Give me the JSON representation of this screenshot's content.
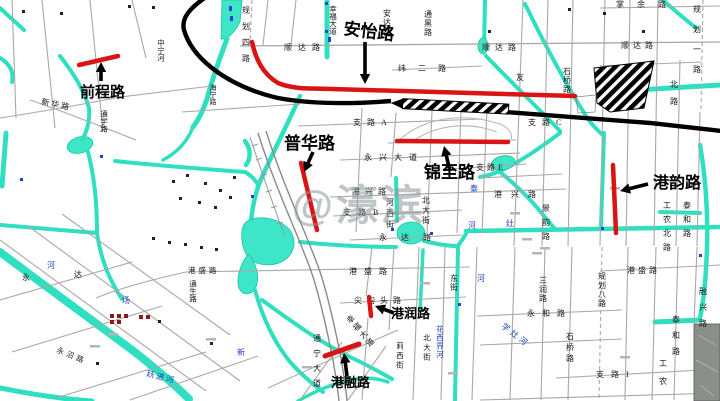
{
  "watermark": {
    "text": "@濠滨"
  },
  "colors": {
    "highlight": "#d81414",
    "river": "#2fdfbf",
    "pond": "#3ce6c6",
    "road_gray": "#a8a8a8",
    "black_road": "#000000",
    "blue_text": "#1d3fbb",
    "label_black": "#161616"
  },
  "highlighted_roads": [
    {
      "name": "前程路",
      "label": {
        "x": 80,
        "y": 97,
        "size": 15,
        "rot": 0
      },
      "path": "M79,65 L118,56",
      "width": 4.5,
      "arrow": {
        "x1": 101,
        "y1": 81,
        "x2": 101,
        "y2": 62
      }
    },
    {
      "name": "安怡路",
      "label": {
        "x": 343,
        "y": 34,
        "size": 17,
        "rot": 7
      },
      "path": "M252,42 C256,60 263,74 278,83 C295,90 312,88 332,89 L575,96",
      "width": 4.5,
      "arrow": {
        "x1": 365,
        "y1": 42,
        "x2": 365,
        "y2": 84
      }
    },
    {
      "name": "普华路",
      "label": {
        "x": 284,
        "y": 149,
        "size": 17,
        "rot": 0
      },
      "path": "M301,163 L317,230",
      "width": 4.5,
      "arrow": {
        "x1": 313,
        "y1": 152,
        "x2": 304,
        "y2": 172
      }
    },
    {
      "name": "锦至路",
      "label": {
        "x": 424,
        "y": 178,
        "size": 17,
        "rot": 0
      },
      "path": "M397,141 L508,142",
      "width": 4.5,
      "arrow": {
        "x1": 450,
        "y1": 171,
        "x2": 444,
        "y2": 146
      }
    },
    {
      "name": "港韵路",
      "label": {
        "x": 653,
        "y": 188,
        "size": 16,
        "rot": 0
      },
      "path": "M613,165 L616,233",
      "width": 4.5,
      "arrow": {
        "x1": 648,
        "y1": 184,
        "x2": 620,
        "y2": 191
      }
    },
    {
      "name": "港润路",
      "label": {
        "x": 391,
        "y": 318,
        "size": 13,
        "rot": 0
      },
      "path": "M369,297 L371,316",
      "width": 4.5,
      "arrow": {
        "x1": 394,
        "y1": 313,
        "x2": 375,
        "y2": 306
      }
    },
    {
      "name": "港融路",
      "label": {
        "x": 331,
        "y": 387,
        "size": 13,
        "rot": 0
      },
      "path": "M325,356 L359,344",
      "width": 5,
      "arrow": {
        "x1": 347,
        "y1": 376,
        "x2": 344,
        "y2": 353
      }
    }
  ],
  "street_labels": [
    {
      "t": "顺达路",
      "x": 284,
      "y": 50,
      "sp": 6
    },
    {
      "t": "规划四路",
      "x": 246,
      "y": 6,
      "o": "v",
      "sp": 8
    },
    {
      "t": "幸福大道",
      "x": 333,
      "y": 5,
      "o": "v",
      "s": 7.5
    },
    {
      "t": "安达路",
      "x": 387,
      "y": 9,
      "o": "v",
      "sp": 1
    },
    {
      "t": "通黑路",
      "x": 428,
      "y": 10,
      "o": "v",
      "sp": 1
    },
    {
      "t": "纬二路",
      "x": 398,
      "y": 71,
      "sp": 12
    },
    {
      "t": "支路A",
      "x": 353,
      "y": 125,
      "sp": 6
    },
    {
      "t": "掌余路",
      "x": 616,
      "y": 7,
      "sp": 13
    },
    {
      "t": "顺达路",
      "x": 482,
      "y": 50,
      "sp": 5
    },
    {
      "t": "顺达路",
      "x": 621,
      "y": 48,
      "sp": 4
    },
    {
      "t": "石桥路",
      "x": 567,
      "y": 67,
      "o": "v",
      "sp": 1
    },
    {
      "t": "友",
      "x": 516,
      "y": 80
    },
    {
      "t": "支路C",
      "x": 528,
      "y": 125,
      "sp": 6
    },
    {
      "t": "规划一路",
      "x": 697,
      "y": 5,
      "o": "v",
      "sp": 12
    },
    {
      "t": "北路",
      "x": 674,
      "y": 80,
      "o": "v",
      "sp": 9
    },
    {
      "t": "永兴大道",
      "x": 364,
      "y": 160,
      "sp": 7
    },
    {
      "t": "港兴路",
      "x": 352,
      "y": 194,
      "sp": 5
    },
    {
      "t": "支路B",
      "x": 343,
      "y": 215,
      "sp": 7
    },
    {
      "t": "支路E",
      "x": 476,
      "y": 170,
      "sp": 3
    },
    {
      "t": "港兴路",
      "x": 494,
      "y": 197,
      "sp": 9
    },
    {
      "t": "北大街",
      "x": 426,
      "y": 196,
      "o": "v",
      "sp": 2
    },
    {
      "t": "河西街",
      "x": 390,
      "y": 198,
      "o": "v",
      "sp": 3
    },
    {
      "t": "景韵路",
      "x": 546,
      "y": 204,
      "o": "v",
      "sp": 6
    },
    {
      "t": "永达路",
      "x": 379,
      "y": 240,
      "sp": 14
    },
    {
      "t": "工农北路",
      "x": 667,
      "y": 201,
      "o": "v",
      "sp": 6
    },
    {
      "t": "泰和路",
      "x": 687,
      "y": 201,
      "o": "v",
      "sp": 6
    },
    {
      "t": "泰和路",
      "x": 676,
      "y": 315,
      "o": "v",
      "sp": 8
    },
    {
      "t": "工农",
      "x": 663,
      "y": 359,
      "o": "v",
      "sp": 10
    },
    {
      "t": "港盛路",
      "x": 349,
      "y": 274,
      "sp": 7
    },
    {
      "t": "港盛路",
      "x": 627,
      "y": 273,
      "sp": 3
    },
    {
      "t": "港盛路",
      "x": 188,
      "y": 273,
      "s": 7.5,
      "sp": 3
    },
    {
      "t": "通生路",
      "x": 193,
      "y": 280,
      "o": "v",
      "s": 7.5
    },
    {
      "t": "尖沟头路",
      "x": 354,
      "y": 303,
      "sp": 5
    },
    {
      "t": "东街",
      "x": 454,
      "y": 274,
      "o": "v",
      "sp": 1
    },
    {
      "t": "规划八路",
      "x": 602,
      "y": 272,
      "o": "v",
      "sp": 1
    },
    {
      "t": "三润路",
      "x": 543,
      "y": 276,
      "o": "v",
      "sp": 1
    },
    {
      "t": "永和路",
      "x": 527,
      "y": 316,
      "sp": 7
    },
    {
      "t": "石桥路",
      "x": 570,
      "y": 332,
      "o": "v",
      "sp": 3
    },
    {
      "t": "支路I",
      "x": 596,
      "y": 377,
      "sp": 7
    },
    {
      "t": "融兴路",
      "x": 703,
      "y": 287,
      "o": "v",
      "sp": 8
    },
    {
      "t": "莉西街",
      "x": 400,
      "y": 342,
      "o": "v",
      "sp": 2,
      "s": 7.5
    },
    {
      "t": "北大街",
      "x": 427,
      "y": 334,
      "o": "v",
      "sp": 2,
      "s": 7.5
    },
    {
      "t": "永",
      "x": 22,
      "y": 280
    },
    {
      "t": "达",
      "x": 74,
      "y": 277
    },
    {
      "t": "新华路",
      "x": 41,
      "y": 104,
      "rot": 12,
      "sp": 2
    },
    {
      "t": "通学路",
      "x": 104,
      "y": 110,
      "o": "v",
      "s": 7.5
    },
    {
      "t": "中宁河",
      "x": 161,
      "y": 39,
      "o": "v",
      "s": 7.5
    },
    {
      "t": "海宁路",
      "x": 213,
      "y": 84,
      "o": "v",
      "s": 7
    },
    {
      "t": "永沼路",
      "x": 56,
      "y": 352,
      "rot": 22,
      "sp": 3,
      "s": 7.5
    },
    {
      "t": "通宁大道",
      "x": 317,
      "y": 334,
      "o": "v",
      "sp": 7
    },
    {
      "t": "幸福大道",
      "x": 348,
      "y": 316,
      "o": "v",
      "sp": 2,
      "rot": -40
    },
    {
      "t": "学灶河",
      "x": 501,
      "y": 327,
      "rot": 38,
      "sp": 3,
      "c": "blue"
    },
    {
      "t": "花西界河",
      "x": 440,
      "y": 325,
      "o": "v",
      "sp": 1,
      "c": "blue",
      "s": 7.5
    },
    {
      "t": "跃进河",
      "x": 146,
      "y": 376,
      "rot": 14,
      "sp": 2,
      "c": "blue"
    },
    {
      "t": "河",
      "x": 468,
      "y": 228,
      "c": "blue"
    },
    {
      "t": "灶",
      "x": 506,
      "y": 226,
      "c": "blue"
    },
    {
      "t": "泰",
      "x": 470,
      "y": 191,
      "c": "blue"
    },
    {
      "t": "场",
      "x": 122,
      "y": 303,
      "c": "blue"
    },
    {
      "t": "河",
      "x": 47,
      "y": 268,
      "c": "blue"
    },
    {
      "t": "新",
      "x": 237,
      "y": 355,
      "c": "blue"
    },
    {
      "t": "河",
      "x": 477,
      "y": 281,
      "c": "blue"
    }
  ]
}
